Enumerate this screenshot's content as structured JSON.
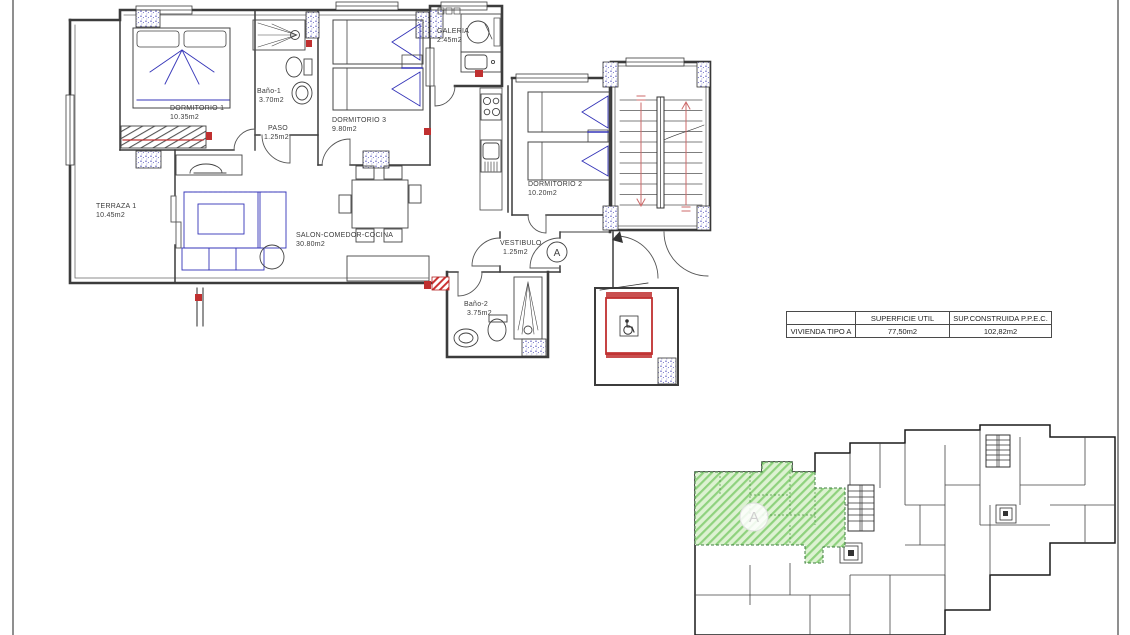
{
  "floor_plan": {
    "rooms": [
      {
        "name": "TERRAZA 1",
        "area": "10.45m2"
      },
      {
        "name": "DORMITORIO 1",
        "area": "10.35m2"
      },
      {
        "name": "Baño-1",
        "area": "3.70m2"
      },
      {
        "name": "PASO",
        "area": "1.25m2"
      },
      {
        "name": "DORMITORIO 3",
        "area": "9.80m2"
      },
      {
        "name": "GALERIA",
        "area": "2.45m2"
      },
      {
        "name": "SALON-COMEDOR-COCINA",
        "area": "30.80m2"
      },
      {
        "name": "DORMITORIO 2",
        "area": "10.20m2"
      },
      {
        "name": "VESTIBULO",
        "area": "1.25m2"
      },
      {
        "name": "Baño-2",
        "area": "3.75m2"
      }
    ],
    "unit_marker": "A"
  },
  "summary_table": {
    "col_headers": [
      "",
      "SUPERFICIE UTIL",
      "SUP.CONSTRUIDA P.P.E.C."
    ],
    "row_label": "VIVIENDA TIPO A",
    "superficie_util": "77,50m2",
    "sup_construida": "102,82m2"
  },
  "key_plan": {
    "highlighted_unit_label": "A",
    "highlight_color": "#bfe8ad"
  },
  "colors": {
    "walls": "#3c3c3c",
    "furniture_blue": "#3434b8",
    "accent_red": "#c03030",
    "stair_arrow": "#cc6a6a",
    "highlight_green": "#ddf2d2",
    "highlight_green_hatch": "#8fd27e",
    "page_border": "#8f8f8f"
  }
}
